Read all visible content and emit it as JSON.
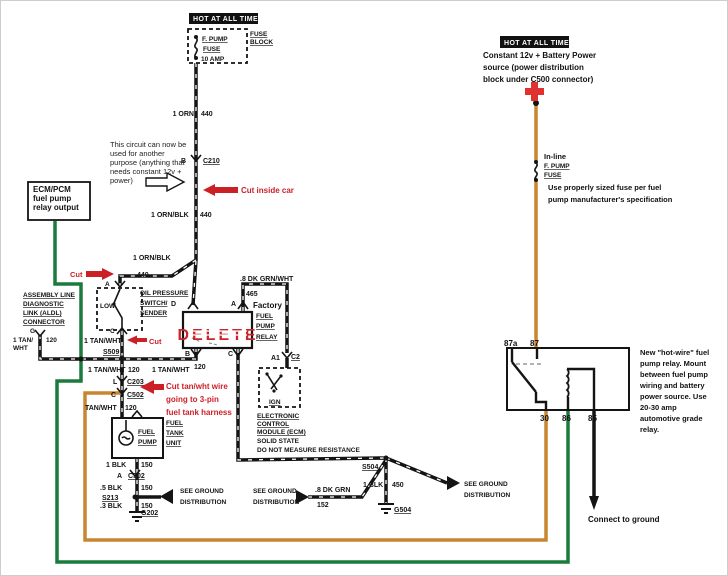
{
  "colors": {
    "wire_black": "#141414",
    "wire_green": "#1b7a3e",
    "wire_orange": "#c9862f",
    "red_accent": "#cc2027",
    "header_bg": "#111111",
    "plus_red": "#e03131"
  },
  "headers": {
    "hot_left": "HOT AT ALL TIMES",
    "hot_right": "HOT AT ALL TIMES"
  },
  "fuse_block": {
    "fuse_name": "F. PUMP",
    "fuse_word": "FUSE",
    "fuse_amp": "10 AMP",
    "label1": "FUSE",
    "label2": "BLOCK"
  },
  "battery_note": {
    "line1": "Constant 12v + Battery Power",
    "line2": "source (power distribution",
    "line3": "block under C500 connector)"
  },
  "inline_fuse": {
    "line1": "In-line",
    "line2": "F. PUMP",
    "line3": "FUSE",
    "note1": "Use properly sized fuse per fuel",
    "note2": "pump manufacturer's specification"
  },
  "circuit_note": {
    "line1": "This circuit can now be",
    "line2": "used for another",
    "line3": "purpose (anything that",
    "line4": "needs constant 12v +",
    "line5": "power)"
  },
  "ecm_pcm": {
    "line1": "ECM/PCM",
    "line2": "fuel pump",
    "line3": "relay output"
  },
  "aldl": {
    "line1": "ASSEMBLY LINE",
    "line2": "DIAGNOSTIC",
    "line3": "LINK (ALDL)",
    "line4": "CONNECTOR",
    "terminal": "G",
    "wire1": "1 TAN/",
    "wire2": "WHT",
    "circuit": "120"
  },
  "oil_switch": {
    "title1": "OIL PRESSURE",
    "title2": "SWITCH/",
    "title3": "SENDER",
    "low": "LOW",
    "term_a": "A",
    "term_c": "C"
  },
  "factory_relay": {
    "delete_label": "DELETE",
    "title1": "Factory",
    "title2": "FUEL",
    "title3": "PUMP",
    "title4": "RELAY",
    "term_d": "D",
    "term_a": "A",
    "term_b": "B",
    "term_c": "C"
  },
  "ecm": {
    "line1": "ELECTRONIC",
    "line2": "CONTROL",
    "line3": "MODULE (ECM)",
    "line4": "SOLID STATE",
    "line5": "DO NOT MEASURE RESISTANCE",
    "ign": "IGN",
    "term_a1": "A1",
    "term_c2": "C2"
  },
  "fuel_tank": {
    "pump1": "FUEL",
    "pump2": "PUMP",
    "unit1": "FUEL",
    "unit2": "TANK",
    "unit3": "UNIT"
  },
  "cuts": {
    "cut_inside_car": "Cut inside car",
    "cut1": "Cut",
    "cut2": "Cut",
    "cut_tan1": "Cut tan/wht wire",
    "cut_tan2": "going to 3-pin",
    "cut_tan3": "fuel tank harness"
  },
  "wire_labels": {
    "orn": "1 ORN",
    "orn_ckt": "440",
    "conn_b": "B",
    "conn_c210": "C210",
    "ornblk1": "1 ORN/BLK",
    "ornblk1_ckt": "440",
    "ornblk2": "1 ORN/BLK",
    "ornblk2_ckt": "440",
    "grnwht": ".8 DK GRN/WHT",
    "grnwht_ckt": "465",
    "tanwht_s509": "1 TAN/WHT",
    "s509": "S509",
    "tanwht_a": "1 TAN/WHT",
    "tanwht_a_ckt": "120",
    "tanwht_b": "1 TAN/WHT",
    "tanwht_b_ckt": "120",
    "conn_l": "L",
    "conn_c203": "C203",
    "conn_c": "C",
    "conn_c502": "C502",
    "tanwht_pump": "TAN/WHT",
    "tanwht_pump_ckt": "120",
    "blk1": "1 BLK",
    "blk1_ckt": "150",
    "conn_a": "A",
    "conn_c502b": "C502",
    "blk5": ".5 BLK",
    "blk5_ckt": "150",
    "s213": "S213",
    "blk3": ".3 BLK",
    "blk3_ckt": "150",
    "g202": "G202",
    "s504": "S504",
    "blk450": "1 BLK",
    "blk450_ckt": "450",
    "g504": "G504",
    "dkgrn": ".8 DK GRN",
    "dkgrn_ckt": "152"
  },
  "grounds": {
    "see1a": "SEE GROUND",
    "see1b": "DISTRIBUTION",
    "see2a": "SEE GROUND",
    "see2b": "DISTRIBUTION",
    "see3a": "SEE GROUND",
    "see3b": "DISTRIBUTION",
    "connect": "Connect to ground"
  },
  "new_relay": {
    "t87a": "87a",
    "t87": "87",
    "t30": "30",
    "t86": "86",
    "t85": "85",
    "note1": "New \"hot-wire\" fuel",
    "note2": "pump relay.  Mount",
    "note3": "between fuel pump",
    "note4": "wiring and battery",
    "note5": "power source. Use",
    "note6": "20-30 amp",
    "note7": "automotive grade",
    "note8": "relay."
  }
}
